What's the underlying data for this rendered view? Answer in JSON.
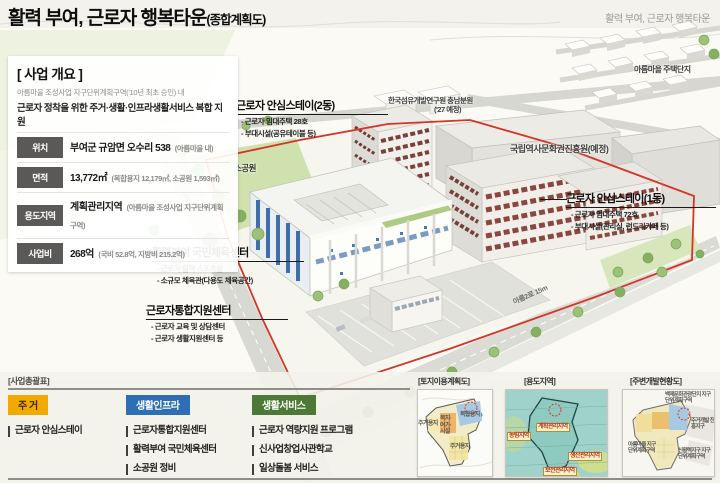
{
  "header": {
    "title": "활력 부여, 근로자 행복타운",
    "suffix": "(종합계획도)",
    "corner": "활력 부여, 근로자 행복타운"
  },
  "overview": {
    "title": "[ 사업 개요 ]",
    "sub1": "아름마을 조성사업 지구단위계획구역('10년 최초 승인) 내",
    "sub2": "근로자 정착을 위한 주거·생활·인프라생활서비스 복합 지원",
    "rows": [
      {
        "label": "위치",
        "value": "부여군 규암면 오수리 538",
        "note": "(아름마을 내)"
      },
      {
        "label": "면적",
        "value": "13,772㎡",
        "note": "(복합용지 12,179㎡, 소공원 1,593㎡)"
      },
      {
        "label": "용도지역",
        "value": "계획관리지역",
        "note": "(아름마을 조성사업 지구단위계획구역)"
      },
      {
        "label": "사업비",
        "value": "268억",
        "note": "(국비 52.8억, 지방비 215.2억)"
      }
    ]
  },
  "plan": {
    "callouts": {
      "stay2": {
        "title": "근로자 안심스테이(2동)",
        "items": [
          "- 근로자 임대주택 28호",
          "- 부대시설(공유테이블 등)"
        ]
      },
      "gym": {
        "title": "활력부여 국민체육센터",
        "items": [
          "- 근로자 활력 스포츠실",
          "- 소규모 체육관(다용도 체육공간)"
        ]
      },
      "support": {
        "title": "근로자통합지원센터",
        "items": [
          "- 근로자 교육 및 상담센터",
          "- 근로자 생활지원센터 등"
        ]
      },
      "stay1": {
        "title": "근로자 안심스테이(1동)",
        "items": [
          "- 근로자 임대주택 72호",
          "- 부대시설(관리실, 런드리카페 등)"
        ]
      }
    },
    "labels": {
      "textile1": "한국섬유개발연구원 충남분원",
      "textile2": "('27 예정)",
      "heritage": "국립역사문화권진흥원(예정)",
      "village": "아름마을 주택단지",
      "park": "소공원",
      "road_left": "15m",
      "road_bottom": "아름2로 15m"
    },
    "boundary_color": "#d63426"
  },
  "summary": {
    "title": "[사업총괄표]",
    "columns": [
      {
        "badge": "주 거",
        "color": "#f2a900",
        "text_color": "#3d2a00",
        "items": [
          "근로자 안심스테이"
        ]
      },
      {
        "badge": "생활인프라",
        "color": "#2d6eb5",
        "text_color": "#ffffff",
        "items": [
          "근로자통합지원센터",
          "활력부여 국민체육센터",
          "소공원 정비"
        ]
      },
      {
        "badge": "생활서비스",
        "color": "#4c7a36",
        "text_color": "#ffffff",
        "items": [
          "근로자 역량지원 프로그램",
          "신사업창업사관학교",
          "일상돌봄 서비스"
        ]
      }
    ]
  },
  "minimaps": [
    {
      "title": "[토지이용계획도]",
      "labels": [
        "주거용지",
        "복지·여가·시설",
        "복합용지",
        "주거용지"
      ]
    },
    {
      "title": "[용도지역]",
      "labels": [
        "농림지역",
        "계획관리지역",
        "생산관리지역",
        "보전관리지역"
      ]
    },
    {
      "title": "[주변개발현황도]",
      "labels": [
        "백제문화관광단지 지구단위계획구역",
        "주거개발 진흥지구",
        "아름마을 지구단위계획구역",
        "신활력지구 지구단위계획구역"
      ]
    }
  ]
}
